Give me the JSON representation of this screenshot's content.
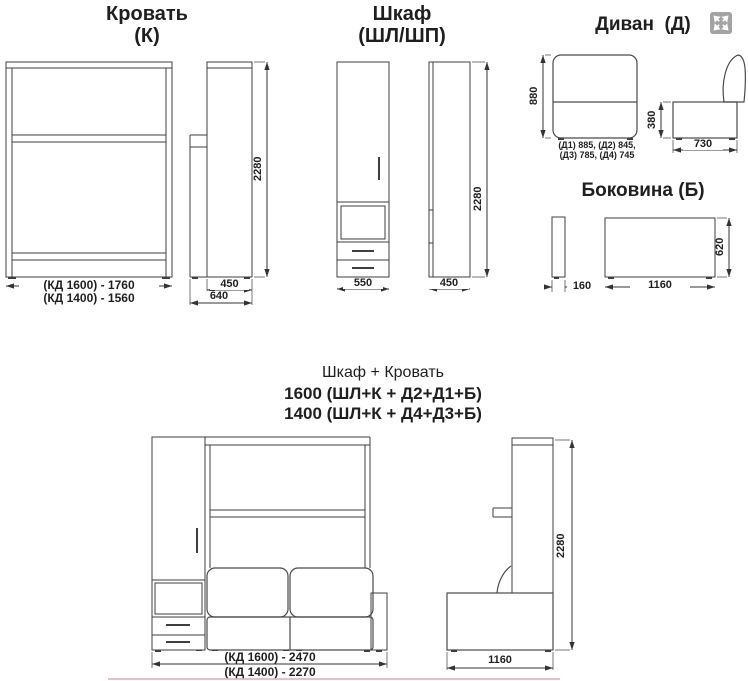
{
  "colors": {
    "background": "#ffffff",
    "line": "#3f3f3f",
    "text": "#1f1f1f",
    "icon_bg": "#a3a3a3",
    "progress_bar": "#dd9c9c"
  },
  "icons": {
    "expand": "expand-arrows-icon"
  },
  "bed": {
    "title": "Кровать",
    "code": "(К)",
    "height": "2280",
    "width_1600": "(КД 1600) - 1760",
    "width_1400": "(КД 1400) - 1560",
    "depth_body": "450",
    "depth_total": "640"
  },
  "wardrobe": {
    "title": "Шкаф",
    "code": "(ШЛ/ШП)",
    "height": "2280",
    "width": "550",
    "depth": "450"
  },
  "sofa": {
    "title": "Диван  (Д)",
    "height": "880",
    "widths_row1": "(Д1) 885, (Д2) 845,",
    "widths_row2": "(Д3) 785, (Д4) 745",
    "seat_height": "380",
    "depth": "730"
  },
  "side_panel": {
    "title": "Боковина (Б)",
    "thickness": "160",
    "length": "1160",
    "height": "620"
  },
  "combo": {
    "title": "Шкаф + Кровать",
    "variant_1600": "1600 (ШЛ+К + Д2+Д1+Б)",
    "variant_1400": "1400 (ШЛ+К + Д4+Д3+Б)",
    "width_1600": "(КД 1600) - 2470",
    "width_1400": "(КД 1400) - 2270",
    "height": "2280",
    "depth": "1160"
  }
}
